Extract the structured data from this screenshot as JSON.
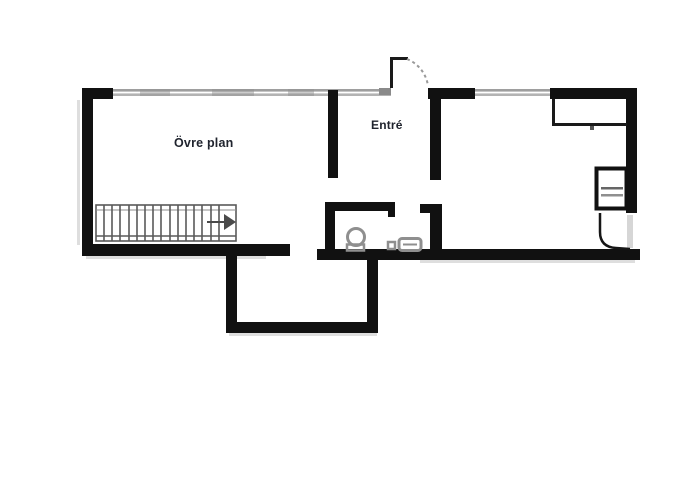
{
  "floorplan": {
    "labels": {
      "upper_floor": "Övre plan",
      "entrance": "Entré"
    },
    "colors": {
      "wall": "#111111",
      "window_band": "#9e9e9e",
      "stairs_line": "#5a5a5a",
      "fixture": "#8f8f8f",
      "label_text": "#20242e",
      "background": "#ffffff"
    },
    "icons": [
      "stairs-icon",
      "stairs-direction-arrow-icon",
      "toilet-icon",
      "sink-icon",
      "wardrobe-icon",
      "appliance-icon",
      "entry-door-swing-icon",
      "right-door-swing-icon",
      "window-band-icon"
    ]
  }
}
